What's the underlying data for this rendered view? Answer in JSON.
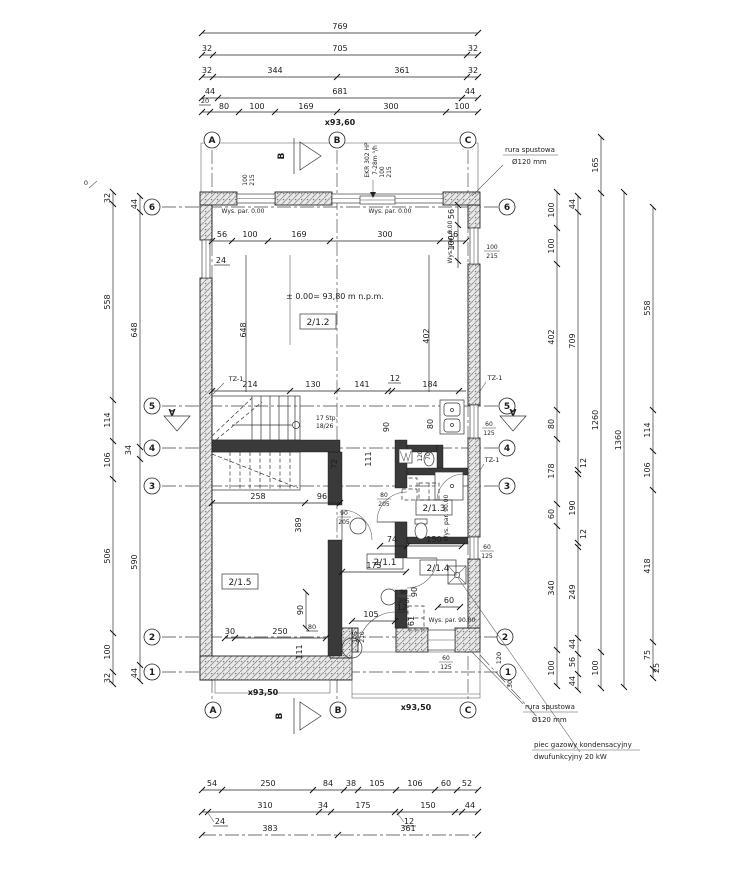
{
  "axes": {
    "A": "A",
    "B": "B",
    "C": "C",
    "n1": "1",
    "n2": "2",
    "n3": "3",
    "n4": "4",
    "n5": "5",
    "n6": "6"
  },
  "levels": {
    "top": "x93,60",
    "bottom": "x93,50",
    "terrace": "x93,50",
    "floor": "± 0.00= 93,80 m n.p.m.",
    "zero": "0"
  },
  "rooms": {
    "r11": "2/1.1",
    "r12": "2/1.2",
    "r13": "2/1.3",
    "r14": "2/1.4",
    "r15": "2/1.5"
  },
  "notes": {
    "downpipe": "rura spustowa",
    "downpipe_d": "Ø120 mm",
    "boiler1": "piec gazowy kondensacyjny",
    "boiler2": "dwufunkcyjny 20 kW",
    "vent1": "EKR 302 HP",
    "vent2": "7-28m ³/h",
    "stairs1": "17 Stp.",
    "stairs2": "18/26",
    "beam": "TZ-1",
    "sill0": "Wys. par. 0.00",
    "sill90": "Wys. par. 90.00",
    "section_a": "A",
    "section_b": "B"
  },
  "dims": {
    "t1": [
      "769"
    ],
    "t2": [
      "32",
      "705",
      "32"
    ],
    "t3": [
      "32",
      "344",
      "361",
      "32"
    ],
    "t4": [
      "44",
      "681",
      "44"
    ],
    "t5": [
      "20",
      "80",
      "100",
      "169",
      "300",
      "100"
    ],
    "b1": [
      "54",
      "250",
      "84",
      "38",
      "105",
      "106",
      "60",
      "52"
    ],
    "b2": [
      "24",
      "310",
      "34",
      "175",
      "12",
      "150",
      "44"
    ],
    "b3": [
      "383",
      "361"
    ],
    "lo": [
      "32",
      "558",
      "114",
      "106",
      "506",
      "100",
      "32"
    ],
    "li": [
      "44",
      "648",
      "34",
      "590",
      "44"
    ],
    "r1": [
      "100",
      "100",
      "402",
      "80",
      "178",
      "60",
      "340",
      "100"
    ],
    "r2": [
      "44",
      "709",
      "12",
      "190",
      "12",
      "249",
      "44",
      "56",
      "44"
    ],
    "r3": [
      "165",
      "1260",
      "100"
    ],
    "r4": [
      "1360"
    ],
    "r5": [
      "558",
      "114",
      "106",
      "418",
      "75",
      "25"
    ],
    "i_top": [
      "56",
      "100",
      "169",
      "300",
      "56"
    ],
    "i24": "24",
    "iw56": "56",
    "iw100": "100",
    "i648": "648",
    "i402": "402",
    "i5": [
      "214",
      "130",
      "141",
      "12",
      "184"
    ],
    "i90a": "90",
    "i80": "80",
    "i72": "72",
    "i111": "111",
    "i258": "258",
    "i96": "96",
    "i389": "389",
    "i74": "74",
    "i150": "150",
    "i175": "175",
    "i105": "105",
    "i12": "12",
    "i61": "61",
    "i90b": "90",
    "i60": "60",
    "i90c": "90",
    "i30": "30",
    "i250": "250",
    "i111b": "111",
    "i80b": "80",
    "c120": "120",
    "c30": "30"
  },
  "openings": {
    "w1": [
      "100",
      "215"
    ],
    "w2": [
      "105",
      "210"
    ],
    "d1": [
      "90",
      "205"
    ],
    "d2": [
      "80",
      "205"
    ],
    "w3": [
      "60",
      "125"
    ],
    "w4": [
      "120",
      "70"
    ]
  }
}
